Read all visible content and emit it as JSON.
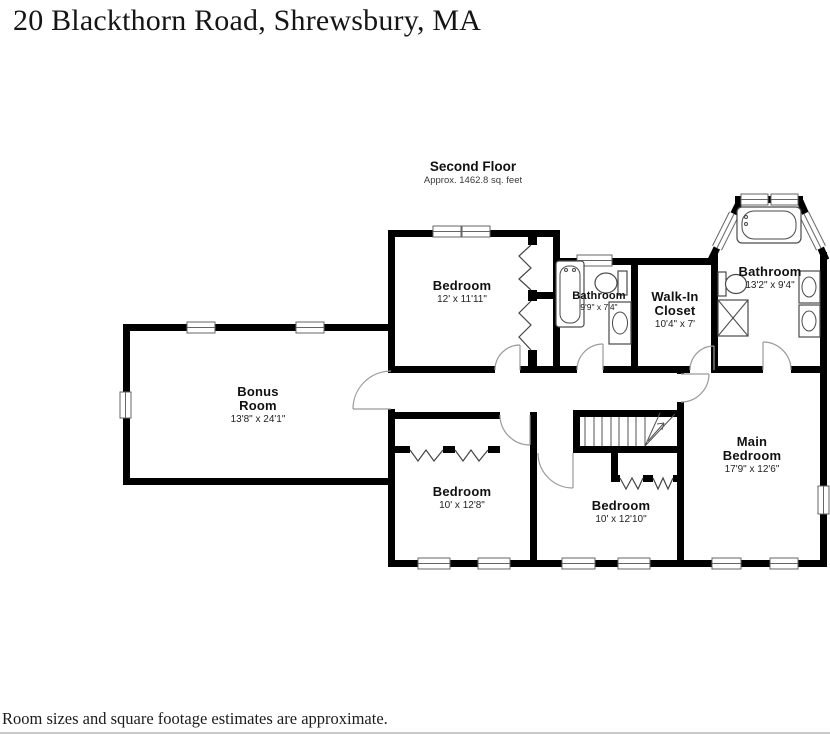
{
  "page": {
    "title": "20 Blackthorn Road, Shrewsbury, MA",
    "footer_note": "Room sizes and square footage estimates are approximate."
  },
  "floor": {
    "name": "Second Floor",
    "area_note": "Approx. 1462.8 sq. feet"
  },
  "rooms": [
    {
      "name_lines": [
        "Bedroom"
      ],
      "dims": "12' x 11'11\""
    },
    {
      "name_lines": [
        "Bathroom"
      ],
      "dims": "9'9\" x 7'4\""
    },
    {
      "name_lines": [
        "Walk-In",
        "Closet"
      ],
      "dims": "10'4\" x 7'"
    },
    {
      "name_lines": [
        "Bathroom"
      ],
      "dims": "13'2\" x 9'4\""
    },
    {
      "name_lines": [
        "Bonus",
        "Room"
      ],
      "dims": "13'8\" x 24'1\""
    },
    {
      "name_lines": [
        "Bedroom"
      ],
      "dims": "10' x 12'8\""
    },
    {
      "name_lines": [
        "Bedroom"
      ],
      "dims": "10' x 12'10\""
    },
    {
      "name_lines": [
        "Main",
        "Bedroom"
      ],
      "dims": "17'9\" x 12'6\""
    }
  ],
  "colors": {
    "wall": "#000000",
    "fixture_outline": "#4a4a4a",
    "window_frame": "#666666",
    "door_arc": "#9a9a9a",
    "text": "#111111"
  }
}
